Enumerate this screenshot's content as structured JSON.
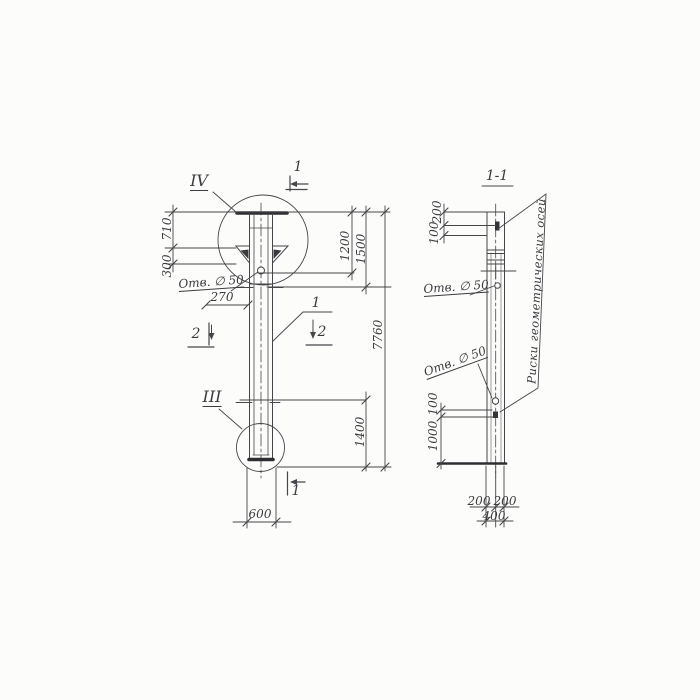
{
  "left_view": {
    "detail_marker_top": "IV",
    "detail_marker_bottom": "III",
    "section_mark_top": "1",
    "section_mark_bottom": "1",
    "section_mark_left": "2",
    "section_mark_right": "2",
    "part_callout": "1",
    "hole_label": "Отв. ∅ 50",
    "dim_710": "710",
    "dim_300": "300",
    "dim_270": "270",
    "dim_1200": "1200",
    "dim_1500": "1500",
    "dim_7760": "7760",
    "dim_1400": "1400",
    "dim_600": "600"
  },
  "section_view": {
    "title": "1-1",
    "hole_label_top": "Отв. ∅ 50",
    "hole_label_bottom": "Отв. ∅ 50",
    "axes_note": "Риски геометрических осей",
    "dim_200_top": "200",
    "dim_100_top": "100",
    "dim_100_mid": "100",
    "dim_1000": "1000",
    "dim_200_bottom_left": "200",
    "dim_200_bottom_right": "200",
    "dim_400": "400"
  },
  "colors": {
    "line": "#46464a",
    "thick": "#2e2e32",
    "paper": "#fcfcfb"
  }
}
